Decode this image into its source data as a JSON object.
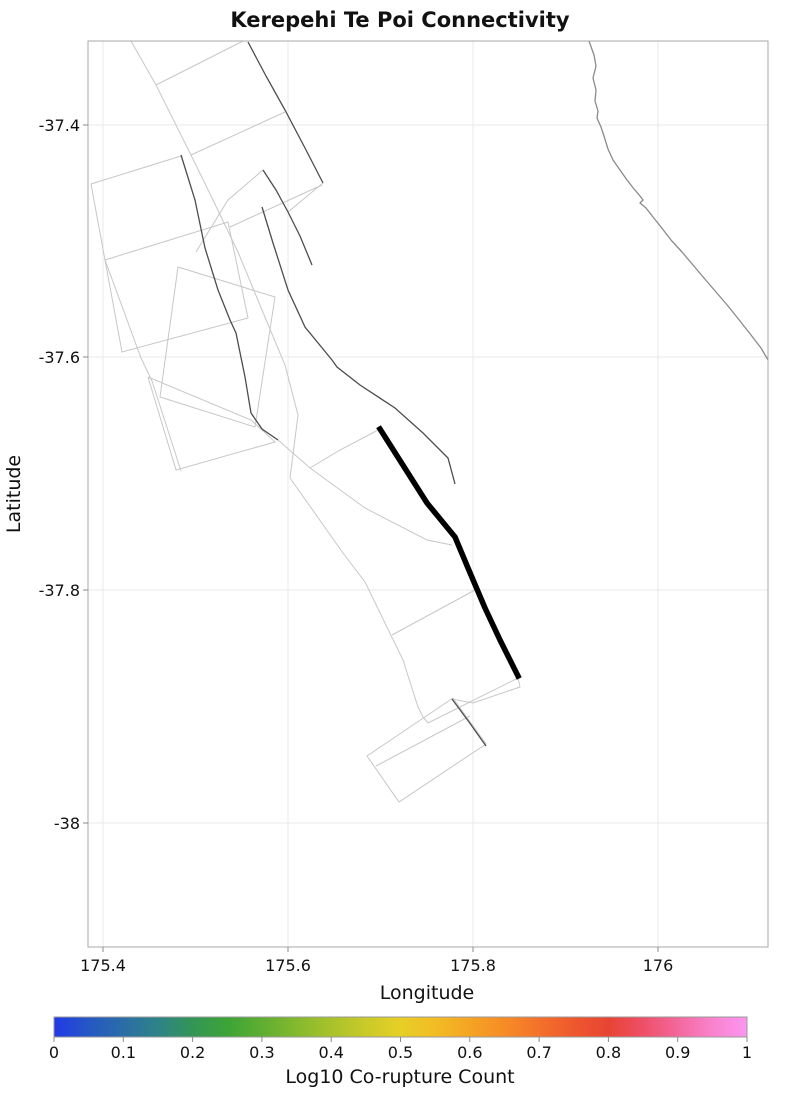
{
  "title": "Kerepehi Te Poi Connectivity",
  "axes": {
    "xlabel": "Longitude",
    "ylabel": "Latitude",
    "x_tick_labels": [
      "175.4",
      "175.6",
      "175.8",
      "176"
    ],
    "y_tick_labels": [
      "-37.4",
      "-37.6",
      "-37.8",
      "-38"
    ]
  },
  "colorbar": {
    "label": "Log10 Co-rupture Count",
    "tick_labels": [
      "0",
      "0.1",
      "0.2",
      "0.3",
      "0.4",
      "0.5",
      "0.6",
      "0.7",
      "0.8",
      "0.9",
      "1"
    ],
    "gradient_stops": [
      [
        0.0,
        "#2239e6"
      ],
      [
        0.05,
        "#2558c4"
      ],
      [
        0.1,
        "#2b6da6"
      ],
      [
        0.15,
        "#2e8387"
      ],
      [
        0.2,
        "#339556"
      ],
      [
        0.25,
        "#3da437"
      ],
      [
        0.3,
        "#5fae31"
      ],
      [
        0.35,
        "#84b92e"
      ],
      [
        0.4,
        "#a8c22b"
      ],
      [
        0.45,
        "#c9ca28"
      ],
      [
        0.5,
        "#e7cf26"
      ],
      [
        0.55,
        "#f2bc25"
      ],
      [
        0.6,
        "#f5a424"
      ],
      [
        0.65,
        "#f68c26"
      ],
      [
        0.7,
        "#f4712a"
      ],
      [
        0.75,
        "#ee582e"
      ],
      [
        0.8,
        "#e84433"
      ],
      [
        0.85,
        "#ee4f68"
      ],
      [
        0.9,
        "#f4679c"
      ],
      [
        0.95,
        "#f982cd"
      ],
      [
        1.0,
        "#fb96f1"
      ]
    ]
  },
  "chart_data": {
    "type": "map",
    "title": "Kerepehi Te Poi Connectivity",
    "xlabel": "Longitude",
    "ylabel": "Latitude",
    "xlim": [
      175.38,
      176.12
    ],
    "ylim": [
      -38.11,
      -37.33
    ],
    "x_ticks": [
      175.4,
      175.6,
      175.8,
      176.0
    ],
    "y_ticks": [
      -37.4,
      -37.6,
      -37.8,
      -38.0
    ],
    "grid": true,
    "colorbar": {
      "label": "Log10 Co-rupture Count",
      "range": [
        0,
        1
      ],
      "ticks": [
        0,
        0.1,
        0.2,
        0.3,
        0.4,
        0.5,
        0.6,
        0.7,
        0.8,
        0.9,
        1
      ]
    },
    "legend_position": "none",
    "highlighted_fault_trace_lonlat": [
      [
        175.7,
        -37.66
      ],
      [
        175.75,
        -37.72
      ],
      [
        175.78,
        -37.75
      ],
      [
        175.8,
        -37.78
      ],
      [
        175.81,
        -37.81
      ],
      [
        175.83,
        -37.84
      ],
      [
        175.85,
        -37.87
      ]
    ],
    "coastline_lonlat_endpoints": [
      [
        175.93,
        -37.33
      ],
      [
        176.12,
        -37.6
      ]
    ],
    "layers": [
      "fault surface projection outlines (light gray)",
      "fault traces (dark gray)",
      "highlighted Kerepehi Te Poi fault trace (thick black)",
      "coastline (gray)"
    ]
  },
  "map_layers": {
    "colors": {
      "grid": "#e9e9e9",
      "frame": "#a8a8a8",
      "tick": "#8a8a8a",
      "light_path": "#c7c7c7",
      "dark_path": "#4d4d4d",
      "highlight": "#000000",
      "coast": "#8a8a8a"
    },
    "plot_rect": {
      "x": 88,
      "y": 41,
      "w": 680,
      "h": 906
    },
    "grid_x": [
      103,
      288,
      473,
      658
    ],
    "grid_y": [
      125,
      357,
      590,
      823
    ],
    "colorbar_rect": {
      "x": 54,
      "y": 1017,
      "w": 693,
      "h": 20
    },
    "light_paths": [
      [
        [
          131,
          41
        ],
        [
          156,
          85
        ],
        [
          191,
          155
        ],
        [
          213,
          200
        ],
        [
          238,
          252
        ],
        [
          262,
          310
        ],
        [
          285,
          365
        ],
        [
          298,
          415
        ],
        [
          290,
          478
        ]
      ],
      [
        [
          290,
          478
        ],
        [
          343,
          553
        ],
        [
          365,
          582
        ],
        [
          403,
          660
        ],
        [
          418,
          707
        ],
        [
          423,
          717
        ],
        [
          428,
          723
        ],
        [
          518,
          678
        ]
      ],
      [
        [
          156,
          85
        ],
        [
          243,
          41
        ]
      ],
      [
        [
          191,
          155
        ],
        [
          285,
          112
        ]
      ],
      [
        [
          91,
          184
        ],
        [
          181,
          156
        ]
      ],
      [
        [
          91,
          184
        ],
        [
          105,
          260
        ],
        [
          141,
          358
        ],
        [
          152,
          381
        ],
        [
          181,
          471
        ]
      ],
      [
        [
          105,
          260
        ],
        [
          228,
          222
        ],
        [
          248,
          318
        ],
        [
          122,
          352
        ],
        [
          105,
          260
        ]
      ],
      [
        [
          148,
          377
        ],
        [
          251,
          420
        ],
        [
          275,
          442
        ],
        [
          176,
          470
        ],
        [
          148,
          377
        ]
      ],
      [
        [
          263,
          170
        ],
        [
          228,
          200
        ],
        [
          196,
          252
        ]
      ],
      [
        [
          323,
          183
        ],
        [
          288,
          212
        ]
      ],
      [
        [
          230,
          227
        ],
        [
          322,
          185
        ]
      ],
      [
        [
          178,
          267
        ],
        [
          275,
          297
        ],
        [
          255,
          427
        ],
        [
          160,
          397
        ],
        [
          178,
          267
        ]
      ],
      [
        [
          278,
          440
        ],
        [
          310,
          468
        ],
        [
          365,
          508
        ],
        [
          427,
          540
        ],
        [
          452,
          545
        ]
      ],
      [
        [
          392,
          635
        ],
        [
          475,
          590
        ]
      ],
      [
        [
          453,
          698
        ],
        [
          486,
          744
        ],
        [
          399,
          802
        ],
        [
          367,
          756
        ],
        [
          453,
          698
        ]
      ],
      [
        [
          376,
          766
        ],
        [
          470,
          716
        ]
      ],
      [
        [
          380,
          429
        ],
        [
          340,
          450
        ],
        [
          310,
          468
        ]
      ],
      [
        [
          518,
          678
        ],
        [
          520,
          687
        ],
        [
          473,
          703
        ],
        [
          452,
          699
        ]
      ]
    ],
    "dark_paths": [
      [
        [
          248,
          42
        ],
        [
          266,
          76
        ],
        [
          285,
          110
        ],
        [
          305,
          148
        ],
        [
          323,
          183
        ]
      ],
      [
        [
          181,
          155
        ],
        [
          195,
          200
        ],
        [
          205,
          248
        ],
        [
          218,
          290
        ],
        [
          230,
          320
        ],
        [
          236,
          333
        ],
        [
          245,
          377
        ],
        [
          251,
          413
        ],
        [
          262,
          429
        ],
        [
          278,
          440
        ]
      ],
      [
        [
          262,
          207
        ],
        [
          273,
          243
        ],
        [
          288,
          290
        ],
        [
          305,
          327
        ],
        [
          332,
          360
        ],
        [
          337,
          367
        ],
        [
          360,
          385
        ],
        [
          395,
          408
        ],
        [
          423,
          433
        ],
        [
          448,
          458
        ],
        [
          455,
          484
        ]
      ],
      [
        [
          263,
          170
        ],
        [
          276,
          190
        ],
        [
          288,
          212
        ],
        [
          300,
          236
        ],
        [
          312,
          265
        ]
      ],
      [
        [
          452,
          699
        ],
        [
          469,
          722
        ],
        [
          486,
          746
        ]
      ]
    ],
    "highlight_path": [
      [
        380,
        429
      ],
      [
        427,
        503
      ],
      [
        455,
        537
      ],
      [
        468,
        568
      ],
      [
        485,
        608
      ],
      [
        500,
        640
      ],
      [
        518,
        676
      ]
    ],
    "coastline": [
      [
        589,
        41
      ],
      [
        594,
        55
      ],
      [
        596,
        66
      ],
      [
        593,
        78
      ],
      [
        596,
        90
      ],
      [
        595,
        101
      ],
      [
        598,
        111
      ],
      [
        597,
        118
      ],
      [
        601,
        127
      ],
      [
        604,
        136
      ],
      [
        608,
        149
      ],
      [
        613,
        160
      ],
      [
        620,
        170
      ],
      [
        627,
        180
      ],
      [
        634,
        189
      ],
      [
        640,
        196
      ],
      [
        643,
        200
      ],
      [
        640,
        203
      ],
      [
        646,
        208
      ],
      [
        653,
        217
      ],
      [
        661,
        227
      ],
      [
        671,
        240
      ],
      [
        682,
        252
      ],
      [
        693,
        265
      ],
      [
        704,
        278
      ],
      [
        716,
        292
      ],
      [
        728,
        306
      ],
      [
        740,
        321
      ],
      [
        751,
        335
      ],
      [
        761,
        348
      ],
      [
        768,
        360
      ]
    ]
  }
}
